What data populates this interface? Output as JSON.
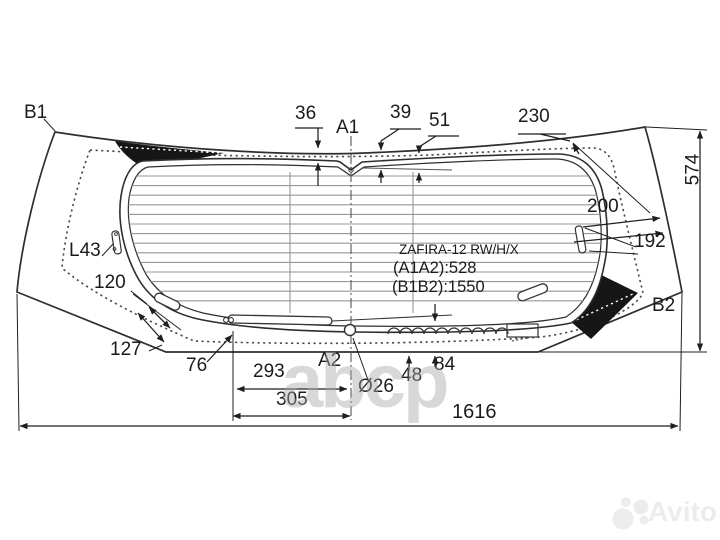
{
  "title_block": {
    "model": "ZAFIRA-12 RW/H/X",
    "a_span": "(A1A2):528",
    "b_span": "(B1B2):1550"
  },
  "markers": {
    "a1": "A1",
    "a2": "A2",
    "b1": "B1",
    "b2": "B2"
  },
  "dimensions": {
    "d36": "36",
    "d39": "39",
    "d51": "51",
    "d230": "230",
    "d574": "574",
    "d200": "200",
    "d192": "192",
    "dL43": "L43",
    "d120": "120",
    "d127": "127",
    "d76": "76",
    "d293": "293",
    "d305": "305",
    "d26": "Ø26",
    "d48": "48",
    "d84": "84",
    "d1616": "1616"
  },
  "watermarks": {
    "ghost": "abcp",
    "brand": "Avito"
  },
  "colors": {
    "line": "#2e2e2e",
    "black_fill": "#161616",
    "watermark": "#ececec"
  }
}
